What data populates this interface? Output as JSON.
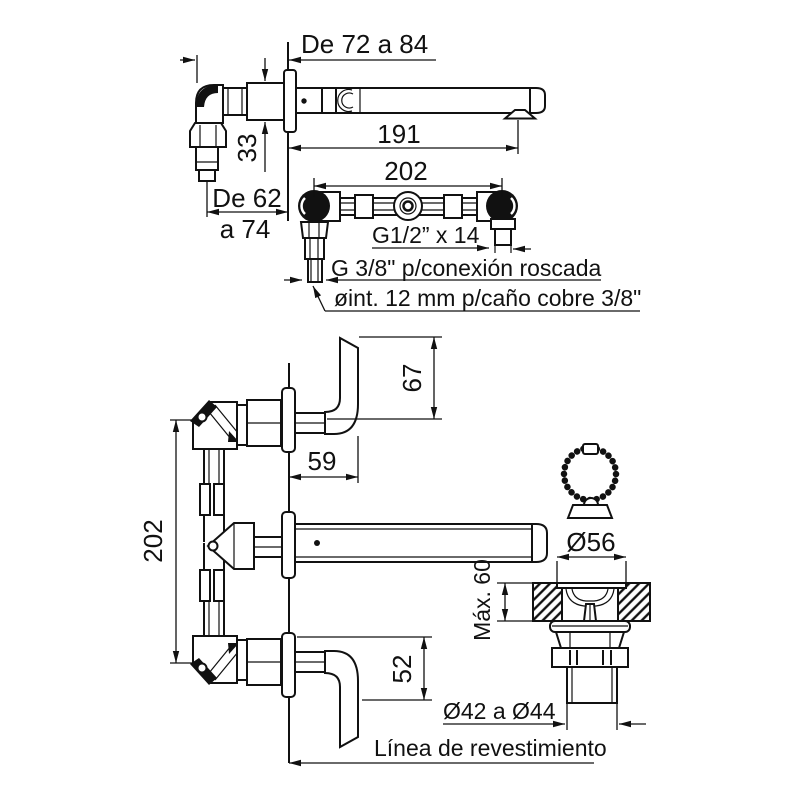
{
  "colors": {
    "line": "#111111",
    "background": "#ffffff"
  },
  "side_view": {
    "embed_depth_range": "De 72 a 84",
    "spout_length": "191",
    "body_height": "33",
    "inlet_depth_line1": "De 62",
    "inlet_depth_line2": "a 74"
  },
  "manifold_view": {
    "centers_distance": "202",
    "outlet_thread": "G1/2” x 14",
    "inlet_thread_note": "G 3/8\" p/conexión roscada",
    "copper_pipe_note": "øint. 12 mm p/caño cobre 3/8\""
  },
  "front_view": {
    "top_handle_height": "67",
    "handle_offset": "59",
    "valve_centers_distance": "202",
    "bottom_handle_height": "52",
    "finish_line_label": "Línea de revestimiento"
  },
  "drain_view": {
    "flange_diameter": "Ø56",
    "max_deck_thickness": "Máx. 60",
    "tailpiece_diameter_range": "Ø42 a Ø44"
  }
}
